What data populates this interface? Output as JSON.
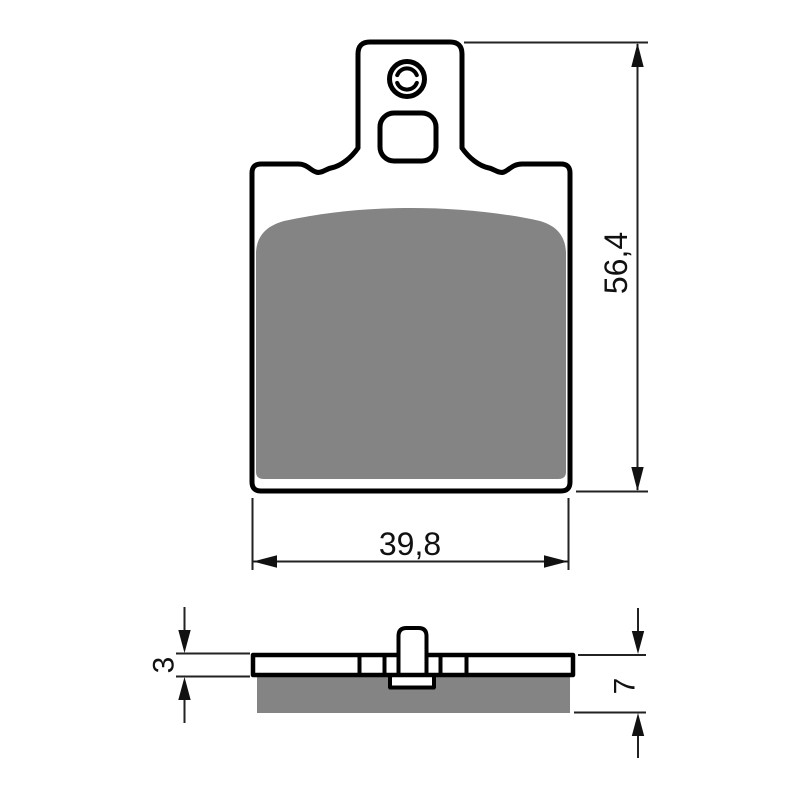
{
  "drawing": {
    "type": "technical-dimension-drawing",
    "subject": "brake pad set, front and side profile views",
    "colors": {
      "outline": "#000000",
      "friction_material": "#848484",
      "dimension_lines": "#222222",
      "background": "#ffffff"
    },
    "front_view": {
      "height_dimension": {
        "value": "56,4"
      },
      "width_dimension": {
        "value": "39,8"
      }
    },
    "side_view": {
      "backplate_thickness_dimension": {
        "value": "3"
      },
      "pad_thickness_dimension": {
        "value": "7"
      }
    }
  }
}
